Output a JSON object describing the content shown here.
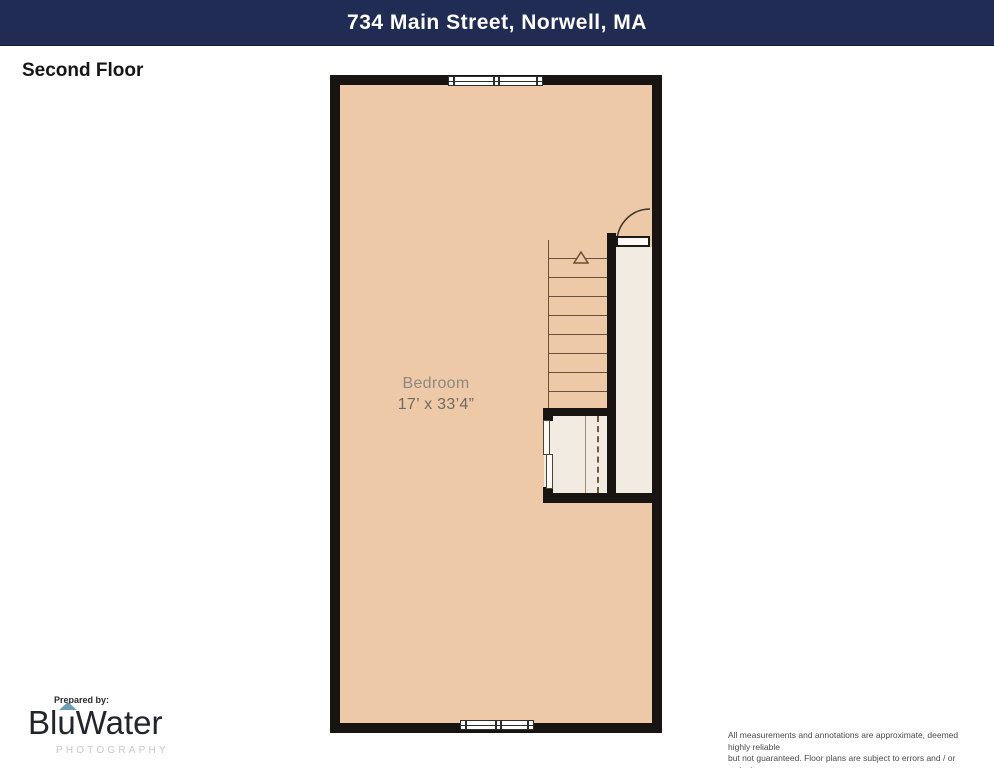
{
  "header": {
    "title": "734 Main Street, Norwell, MA"
  },
  "floor_label": "Second Floor",
  "plan": {
    "room_label": "Bedroom",
    "room_dimensions": "17’ x 33’4”",
    "features": [
      "double-window-top",
      "double-window-bottom",
      "staircase-with-up-arrow",
      "door-with-swing-arc",
      "closet-with-rod-and-shelf"
    ]
  },
  "colors": {
    "header_bg": "#212c55",
    "wall": "#171411",
    "floor_fill": "#eec9a7",
    "stairwell_fill": "#f2ebe2",
    "logo_accent": "#6d9cb5"
  },
  "footer": {
    "prepared_by": "Prepared by:",
    "brand_part1": "Bl",
    "brand_part2": "u",
    "brand_part3": "Water",
    "photography": "PHOTOGRAPHY",
    "disclaimer_line1": "All measurements and annotations are approximate, deemed highly reliable",
    "disclaimer_line2": "but not guaranteed. Floor plans are subject to errors and / or omissions."
  }
}
